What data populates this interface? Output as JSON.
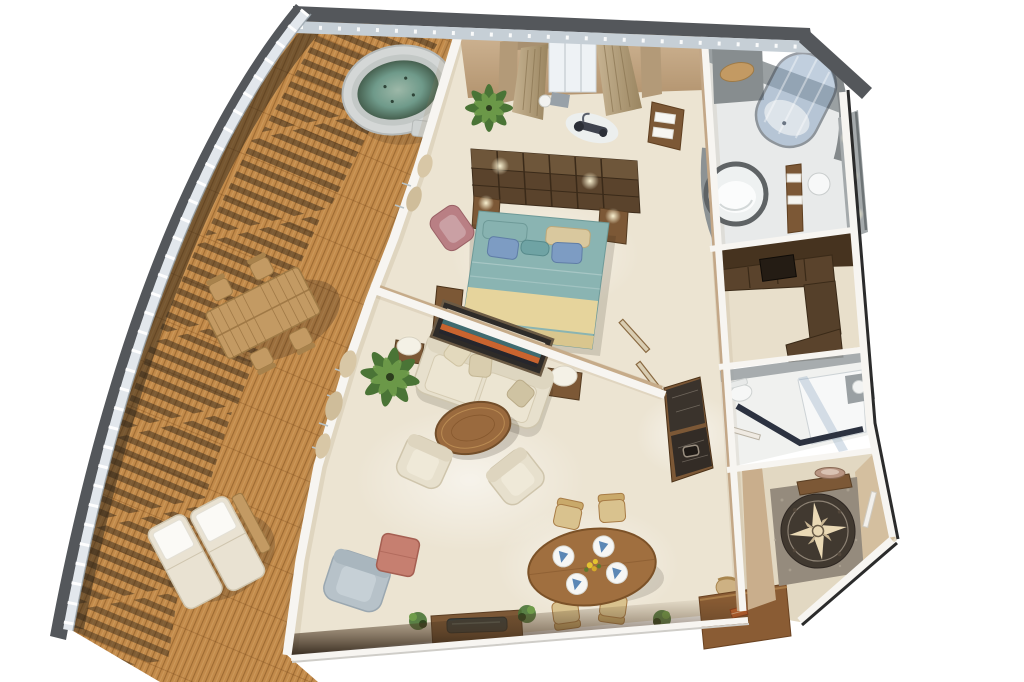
{
  "meta": {
    "title": "3D cutaway floor plan of a luxury ship owner's suite",
    "view": "overhead dollhouse render, no text labels visible",
    "canvas": {
      "width": 1024,
      "height": 682
    }
  },
  "palette": {
    "hull-dark": "#54575b",
    "railing-light": "#e2e7ec",
    "deck-wood": "#c28a4a",
    "deck-plank-dark": "#7a4b1c",
    "deck-plank-light": "#ecc489",
    "deck-shadow": "#2a2116",
    "wall-white": "#f7f5f1",
    "wall-tan": "#c9ae8c",
    "carpet": "#ece4d2",
    "bath-floor": "#e8eaea",
    "bath-gray": "#9aa0a2",
    "wood-dark": "#5a432c",
    "wood-mid": "#7c5836",
    "wood-light": "#c39a63",
    "bed-teal": "#8ab4b2",
    "bed-cream": "#e6d49c",
    "pillow-blue": "#7d9cc3",
    "sofa-cream": "#e7e0cd",
    "chair-gray": "#b7c2c9",
    "ottoman-red": "#c67f70",
    "glass-blue": "#8fa8c4",
    "marble-dark": "#3a332c",
    "foyer-marble": "#413930",
    "compass-cream": "#ead9b5",
    "water-green": "#6f9a8a",
    "plant-green": "#4a7436",
    "accent-orange": "#c9642f",
    "painting-teal": "#3f6b70"
  },
  "rooms": {
    "balcony": {
      "label": "Wrap-around teak balcony deck",
      "items": [
        "whirlpool hot tub with green water",
        "teak dining table with four deck chairs",
        "two sun loungers with white towels",
        "curved ship railing casting ladder shadows on the planks"
      ]
    },
    "bedroom": {
      "label": "Master bedroom",
      "items": [
        "king bed with teal and cream bedding and blue pillows",
        "dark wood headboard shelf wall with reading lamps",
        "two nightstands",
        "bay window with tan drapes",
        "exercise bike on mat",
        "vanity stool",
        "towel cabinet",
        "rose armchair",
        "potted palm",
        "low dresser"
      ]
    },
    "master_bathroom": {
      "label": "Master bathroom",
      "items": [
        "round soaking tub",
        "cylindrical blue-glass shower",
        "lighted vanity wall with sinks",
        "towel ladder",
        "teak bath mat"
      ]
    },
    "closet": {
      "label": "Walk-in wardrobe",
      "items": [
        "L-shaped dark wood wardrobe",
        "overhead cabinet band",
        "dark luggage case"
      ]
    },
    "guest_bathroom": {
      "label": "Guest bathroom",
      "items": [
        "corner glass shower with dark base frame",
        "toilet",
        "gray vanity sink"
      ]
    },
    "living_room": {
      "label": "Living room",
      "items": [
        "cream three-seat sofa with scatter pillows",
        "abstract painting in dark frame",
        "round wood coffee table",
        "two cream armchairs",
        "blue-gray armchair",
        "coral ottoman",
        "media console with TV",
        "two side tables with drum lamps",
        "potted palm",
        "dark granite wet bar with sink",
        "open double doors to bedroom",
        "glass balcony doors with drapes"
      ]
    },
    "dining_area": {
      "label": "Dining area",
      "items": [
        "oval wood table set for four with blue napkins",
        "yellow floral centerpiece",
        "four upholstered chairs"
      ]
    },
    "office": {
      "label": "Writing desk corner",
      "items": [
        "wood writing desk",
        "upholstered desk chair",
        "orange folio",
        "floor plants"
      ]
    },
    "foyer": {
      "label": "Entrance foyer",
      "items": [
        "marble floor with compass rose medallion",
        "console table with decorative bowl"
      ]
    }
  }
}
